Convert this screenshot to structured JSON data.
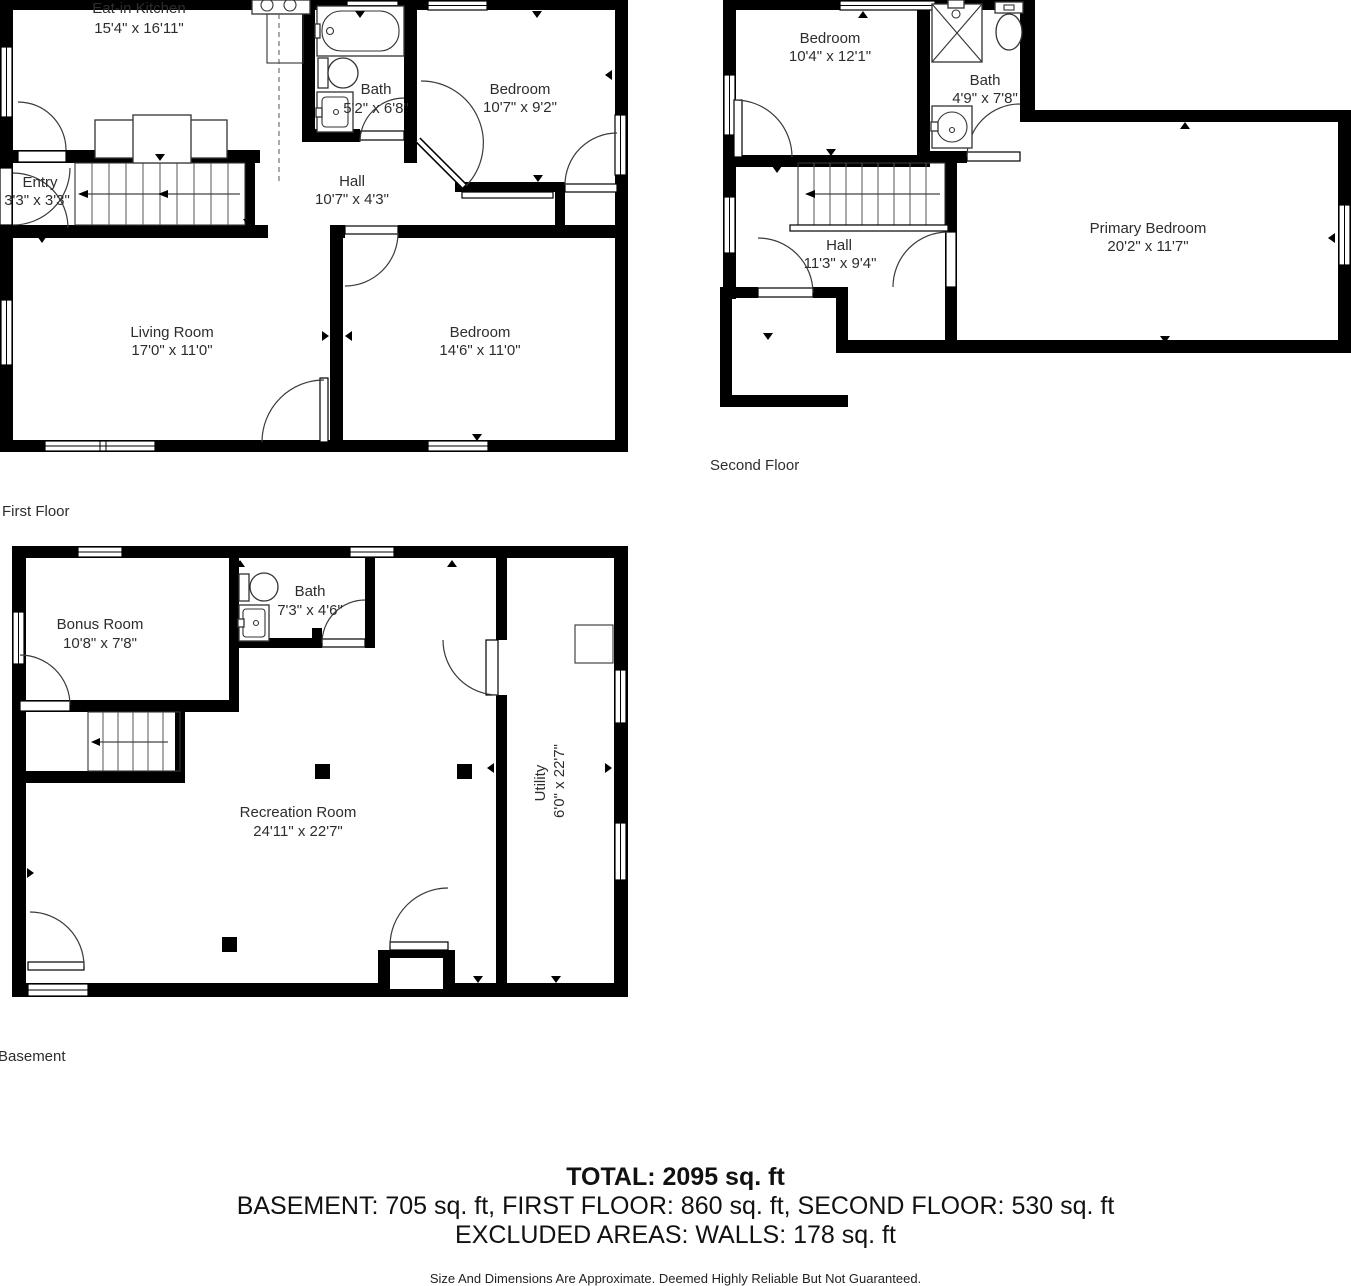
{
  "floors": [
    {
      "label": "First Floor",
      "rooms": [
        {
          "name": "Eat-in Kitchen",
          "dims": "15'4\" x 16'11\""
        },
        {
          "name": "Bath",
          "dims": "5'2\" x 6'8\""
        },
        {
          "name": "Bedroom",
          "dims": "10'7\" x 9'2\""
        },
        {
          "name": "Entry",
          "dims": "3'3\" x 3'3\""
        },
        {
          "name": "Hall",
          "dims": "10'7\" x 4'3\""
        },
        {
          "name": "Living Room",
          "dims": "17'0\" x 11'0\""
        },
        {
          "name": "Bedroom",
          "dims": "14'6\" x 11'0\""
        }
      ]
    },
    {
      "label": "Second Floor",
      "rooms": [
        {
          "name": "Bedroom",
          "dims": "10'4\" x 12'1\""
        },
        {
          "name": "Bath",
          "dims": "4'9\" x 7'8\""
        },
        {
          "name": "Hall",
          "dims": "11'3\" x 9'4\""
        },
        {
          "name": "Primary Bedroom",
          "dims": "20'2\" x 11'7\""
        }
      ]
    },
    {
      "label": "Basement",
      "rooms": [
        {
          "name": "Bonus Room",
          "dims": "10'8\" x 7'8\""
        },
        {
          "name": "Bath",
          "dims": "7'3\" x 4'6\""
        },
        {
          "name": "Recreation Room",
          "dims": "24'11\" x 22'7\""
        },
        {
          "name": "Utility",
          "dims": "6'0\" x 22'7\""
        }
      ]
    }
  ],
  "summary": {
    "total": "TOTAL: 2095 sq. ft",
    "floors_line": "BASEMENT: 705 sq. ft, FIRST FLOOR: 860 sq. ft, SECOND FLOOR: 530 sq. ft",
    "excluded_line": "EXCLUDED AREAS: WALLS: 178 sq. ft",
    "disclaimer": "Size And Dimensions Are Approximate. Deemed Highly Reliable But Not Guaranteed."
  },
  "colors": {
    "wall": "#000000",
    "background": "#ffffff",
    "text": "#2d2d2d"
  }
}
